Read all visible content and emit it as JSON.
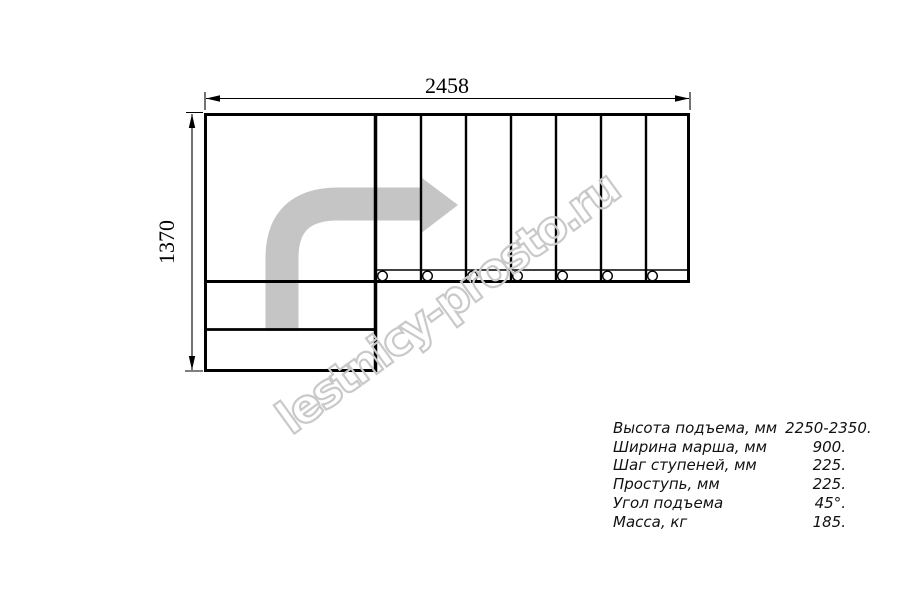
{
  "drawing": {
    "width_dimension_label": "2458",
    "height_dimension_label": "1370",
    "top_flight_step_count": 7,
    "lower_step_count": 2,
    "baluster_count": 7,
    "colors": {
      "line": "#000000",
      "direction_arrow": "#c5c5c5",
      "watermark": "#c9c9c9"
    }
  },
  "watermark": {
    "text": "lestnicy-prosto.ru"
  },
  "spec_table": {
    "rows": [
      {
        "label": "Высота подъема, мм",
        "value": "2250-2350."
      },
      {
        "label": "Ширина марша, мм",
        "value": "900."
      },
      {
        "label": "Шаг ступеней, мм",
        "value": "225."
      },
      {
        "label": "Проступь, мм",
        "value": "225."
      },
      {
        "label": "Угол подъема",
        "value": "45°."
      },
      {
        "label": "Масса, кг",
        "value": "185."
      }
    ]
  }
}
